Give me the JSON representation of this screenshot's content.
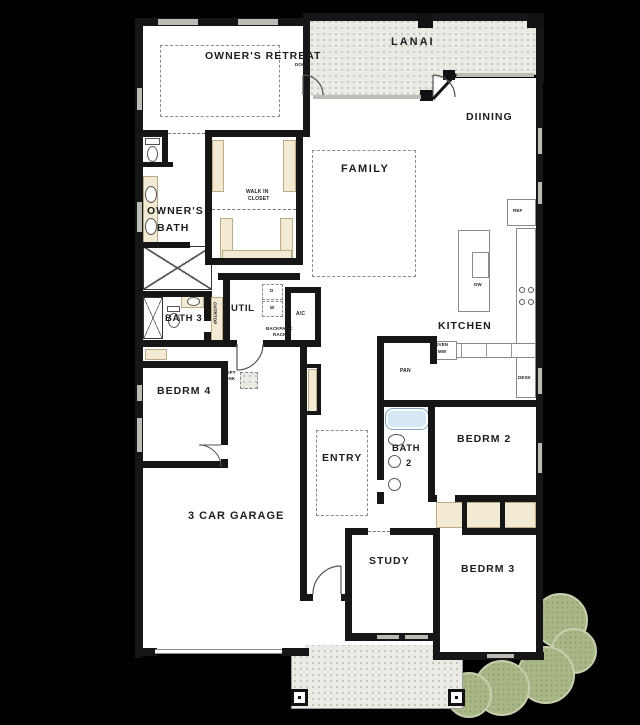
{
  "labels": {
    "owners_retreat": "OWNER'S RETREAT",
    "door": "DOOR",
    "lanai": "LANAI",
    "dining": "DIINING",
    "family": "FAMILY",
    "owners_bath": [
      "OWNER'S",
      "BATH"
    ],
    "walk_in_closet": [
      "WALK IN",
      "CLOSET"
    ],
    "util": "UTIL",
    "bath3": "BATH 3",
    "cntrtop": "CNTRTOP",
    "ac": "A/C",
    "backpack_rack": [
      "BACKPACK",
      "RACK"
    ],
    "bedrm4": "BEDRM 4",
    "opt_sink": [
      "OPT",
      "SINK"
    ],
    "garage": "3 CAR GARAGE",
    "entry": "ENTRY",
    "bath2": [
      "BATH",
      "2"
    ],
    "bedrm2": "BEDRM 2",
    "bedrm3": "BEDRM 3",
    "study": "STUDY",
    "kitchen": "KITCHEN",
    "ref": "REF",
    "dw": "DW",
    "oven_mw": [
      "OVEN",
      "MW"
    ],
    "pan": "PAN",
    "desk": "DESK",
    "dryer": "D",
    "washer": "W"
  },
  "colors": {
    "background": "#000000",
    "wall": "#161616",
    "floor": "#ffffff",
    "outdoor_surface": "#eceae4",
    "closet_beige": "#f3ead3",
    "shrub_green": "#a9b786",
    "tub_blue": "#d5e8f4",
    "window_gray": "#bcbcb6"
  }
}
